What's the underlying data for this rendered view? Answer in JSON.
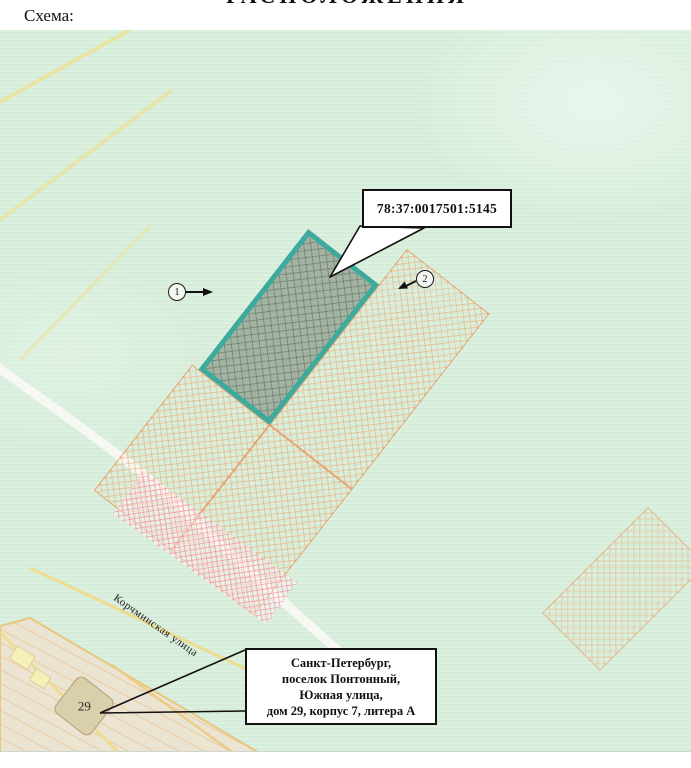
{
  "page": {
    "scheme_label": "Схема:",
    "cropped_title_fragment": "РАСПОЛОЖЕНИЯ"
  },
  "map": {
    "cadastral_callout": "78:37:0017501:5145",
    "address_callout": {
      "line1": "Санкт-Петербург,",
      "line2": "поселок Понтонный,",
      "line3": "Южная улица,",
      "line4": "дом 29, корпус 7, литера А"
    },
    "street_label": "Корчминская улица",
    "building_label": "29",
    "marker1": "1",
    "marker2": "2",
    "colors": {
      "map_background": "#d8eedb",
      "parcel_border": "#3cab9d",
      "parcel_fill": "#8a9a8a",
      "adjacent_hatch": "#eda468",
      "overlay_pink": "#f2869e",
      "road_yellow": "#eedc92",
      "road_white": "#f9f9f5",
      "industrial_zone": "#ece4d2",
      "callout_border": "#111111"
    }
  }
}
